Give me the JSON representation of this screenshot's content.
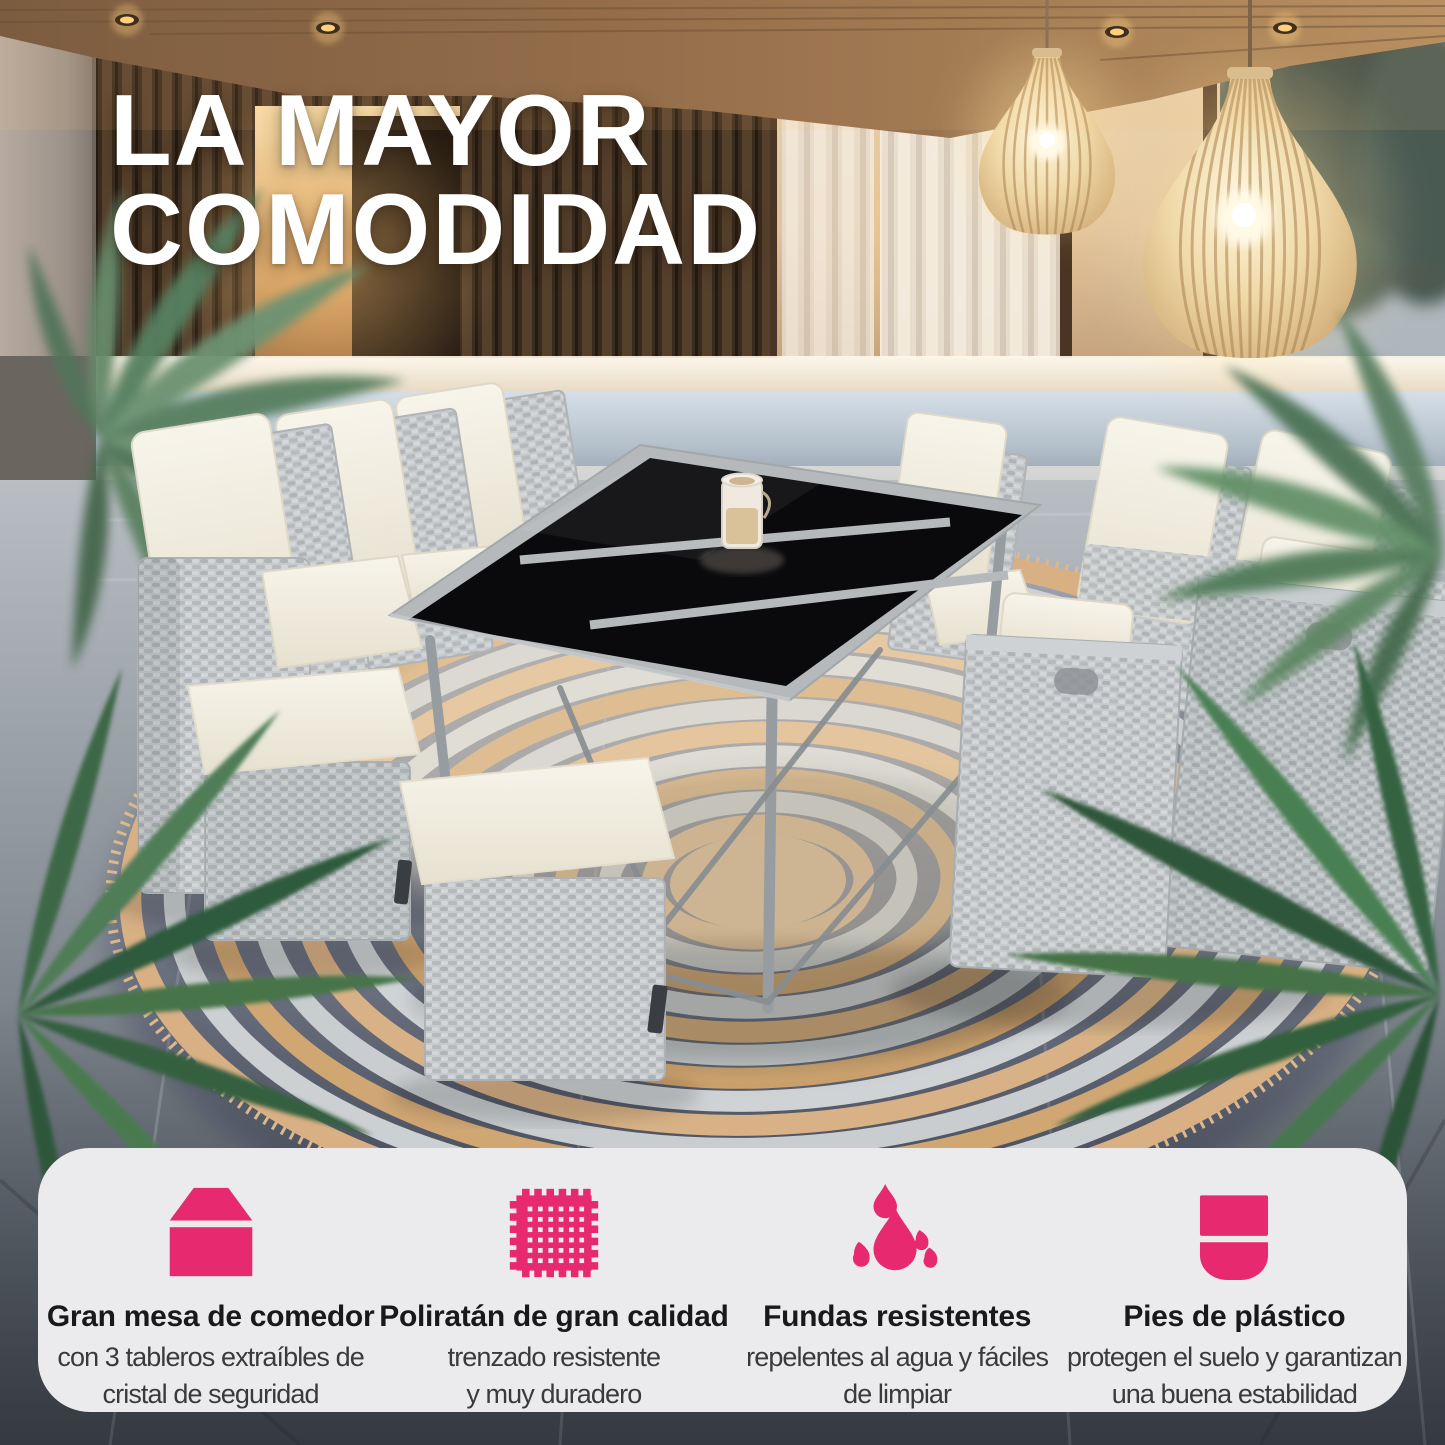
{
  "headline": {
    "line1": "LA MAYOR",
    "line2": "COMODIDAD"
  },
  "features": [
    {
      "icon": "dining-table-icon",
      "title": "Gran mesa de comedor",
      "subtitle": "con 3 tableros extraíbles de\ncristal de seguridad"
    },
    {
      "icon": "rattan-weave-icon",
      "title": "Poliratán de gran calidad",
      "subtitle": "trenzado resistente\ny muy duradero"
    },
    {
      "icon": "water-drops-icon",
      "title": "Fundas resistentes",
      "subtitle": "repelentes al agua y fáciles\nde limpiar"
    },
    {
      "icon": "plastic-foot-icon",
      "title": "Pies de plástico",
      "subtitle": "protegen el suelo y garantizan\nuna buena estabilidad"
    }
  ],
  "colors": {
    "accent_pink": "#E72A6F",
    "card_background": "#EBEBED",
    "headline_color": "#FFFFFF"
  }
}
